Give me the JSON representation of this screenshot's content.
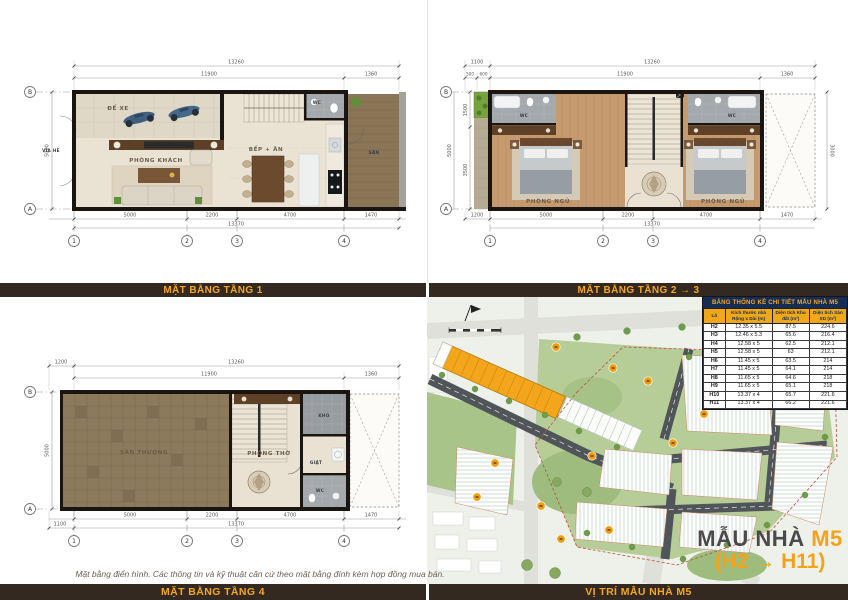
{
  "captions": {
    "floor1": "MẶT BẰNG TẦNG 1",
    "floor23": "MẶT BẰNG TẦNG 2 → 3",
    "floor4": "MẶT BẰNG TẦNG 4",
    "site": "VỊ TRÍ MẪU NHÀ M5"
  },
  "footnote": "Mặt bằng điển hình. Các thông tin và kỹ thuật căn cứ theo mặt bằng đính kèm hợp đồng mua bán.",
  "title_block": {
    "label": "MẪU NHÀ",
    "model": "M5",
    "range": "(H2 → H11)"
  },
  "plan1": {
    "labels": {
      "via_he": "VỈA HÈ",
      "de_xe": "ĐỂ XE",
      "phong_khach": "PHÒNG KHÁCH",
      "bep_an": "BẾP + ĂN",
      "wc": "WC",
      "san": "SÂN"
    },
    "dims": {
      "top_total": "13260",
      "top_main": "11900",
      "top_right": "1360",
      "left": "5000",
      "bot_1": "5000",
      "bot_2": "2200",
      "bot_3": "4700",
      "bot_4": "1470",
      "bot_total": "13370"
    },
    "grid": {
      "c1": "1",
      "c2": "2",
      "c3": "3",
      "c4": "4",
      "ra": "A",
      "rb": "B"
    }
  },
  "plan23": {
    "labels": {
      "wc_left": "WC",
      "wc_right": "WC",
      "bed_left": "PHÒNG NGỦ",
      "bed_right": "PHÒNG NGỦ"
    },
    "dims": {
      "top_offset": "1100",
      "top_total": "13260",
      "s500": "500",
      "s600": "600",
      "top_main": "11900",
      "top_right": "1360",
      "left_total": "5000",
      "left_upper": "1500",
      "left_lower": "3500",
      "right_void": "3000",
      "bot_offset": "1200",
      "bot_1": "5000",
      "bot_2": "2200",
      "bot_3": "4700",
      "bot_4": "1470",
      "bot_total": "13370"
    },
    "grid": {
      "c1": "1",
      "c2": "2",
      "c3": "3",
      "c4": "4",
      "ra": "A",
      "rb": "B"
    }
  },
  "plan4": {
    "labels": {
      "san_thuong": "SÂN THƯỢNG",
      "phong_tho": "PHÒNG THỜ",
      "kho": "KHO",
      "giat": "GIẶT",
      "wc": "WC"
    },
    "dims": {
      "top_offset": "1200",
      "top_total": "13260",
      "top_main": "11900",
      "top_right": "1360",
      "left": "5000",
      "bot_offset": "1100",
      "bot_1": "5000",
      "bot_2": "2200",
      "bot_3": "4700",
      "bot_4": "1470",
      "bot_total": "13370"
    },
    "grid": {
      "c1": "1",
      "c2": "2",
      "c3": "3",
      "c4": "4",
      "ra": "A",
      "rb": "B"
    }
  },
  "table": {
    "title": "BẢNG THỐNG KÊ CHI TIẾT MẪU NHÀ M5",
    "headers": [
      "Lô",
      "Kích thước nhà Rộng x Dài (m)",
      "Diện tích Khu đất (m²)",
      "Diện tích Sàn XD (m²)"
    ],
    "rows": [
      [
        "H2",
        "12.35 x 5.5",
        "87.5",
        "224.6"
      ],
      [
        "H3",
        "12.46 x 5.3",
        "65.6",
        "216.4"
      ],
      [
        "H4",
        "12.58 x 5",
        "62.5",
        "212.1"
      ],
      [
        "H5",
        "12.58 x 5",
        "63",
        "212.1"
      ],
      [
        "H6",
        "11.45 x 5",
        "63.5",
        "214"
      ],
      [
        "H7",
        "11.45 x 5",
        "64.1",
        "214"
      ],
      [
        "H8",
        "11.65 x 5",
        "64.6",
        "218"
      ],
      [
        "H9",
        "11.65 x 5",
        "65.1",
        "218"
      ],
      [
        "H10",
        "13.37 x 4",
        "65.7",
        "221.6"
      ],
      [
        "H11",
        "13.37 x 4",
        "66.2",
        "221.6"
      ]
    ]
  },
  "colors": {
    "accent_orange": "#F5A21B",
    "caption_bar_bg": "#332920",
    "caption_bar_text": "#F5A81C",
    "table_title_bg": "#152D55",
    "table_header_bg": "#F0A818",
    "title_gray": "#4A4A4C",
    "wall_black": "#1A1510",
    "wood_floor": "#C49A6E",
    "terrace_tile": "#8C7A5D",
    "site_green": "#B6CD97",
    "road_dark": "#50555A"
  }
}
